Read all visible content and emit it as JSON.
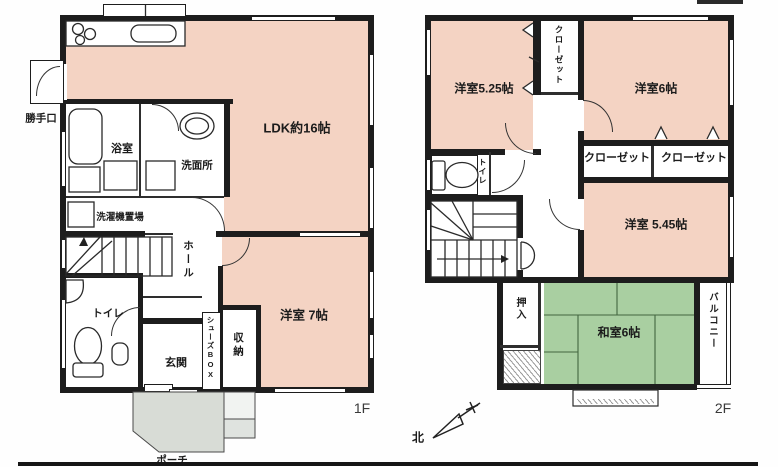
{
  "colors": {
    "wall": "#1d1d1d",
    "room_pink": "#f4d3c3",
    "tatami_green": "#a9cfa1",
    "porch_gray": "#d8dcd6"
  },
  "floor1": {
    "floor_label": "1F",
    "rooms": {
      "ldk": "LDK約16帖",
      "bath": "浴室",
      "washroom": "洗面所",
      "laundry": "洗濯機置場",
      "hall": "ホール",
      "toilet": "トイレ",
      "entrance": "玄関",
      "shoes_box": "シューズBOX",
      "storage": "収納",
      "bedroom7": "洋室 7帖",
      "back_door": "勝手口",
      "porch": "ポーチ"
    }
  },
  "floor2": {
    "floor_label": "2F",
    "rooms": {
      "bedroom525": "洋室5.25帖",
      "closet_upper": "クローゼット",
      "bedroom6": "洋室6帖",
      "closet_left": "クローゼット",
      "closet_right": "クローゼット",
      "toilet": "トイレ",
      "bedroom545": "洋室 5.45帖",
      "oshiire": "押入",
      "tatami6": "和室6帖",
      "balcony": "バルコニー"
    }
  },
  "compass": {
    "north": "北"
  }
}
